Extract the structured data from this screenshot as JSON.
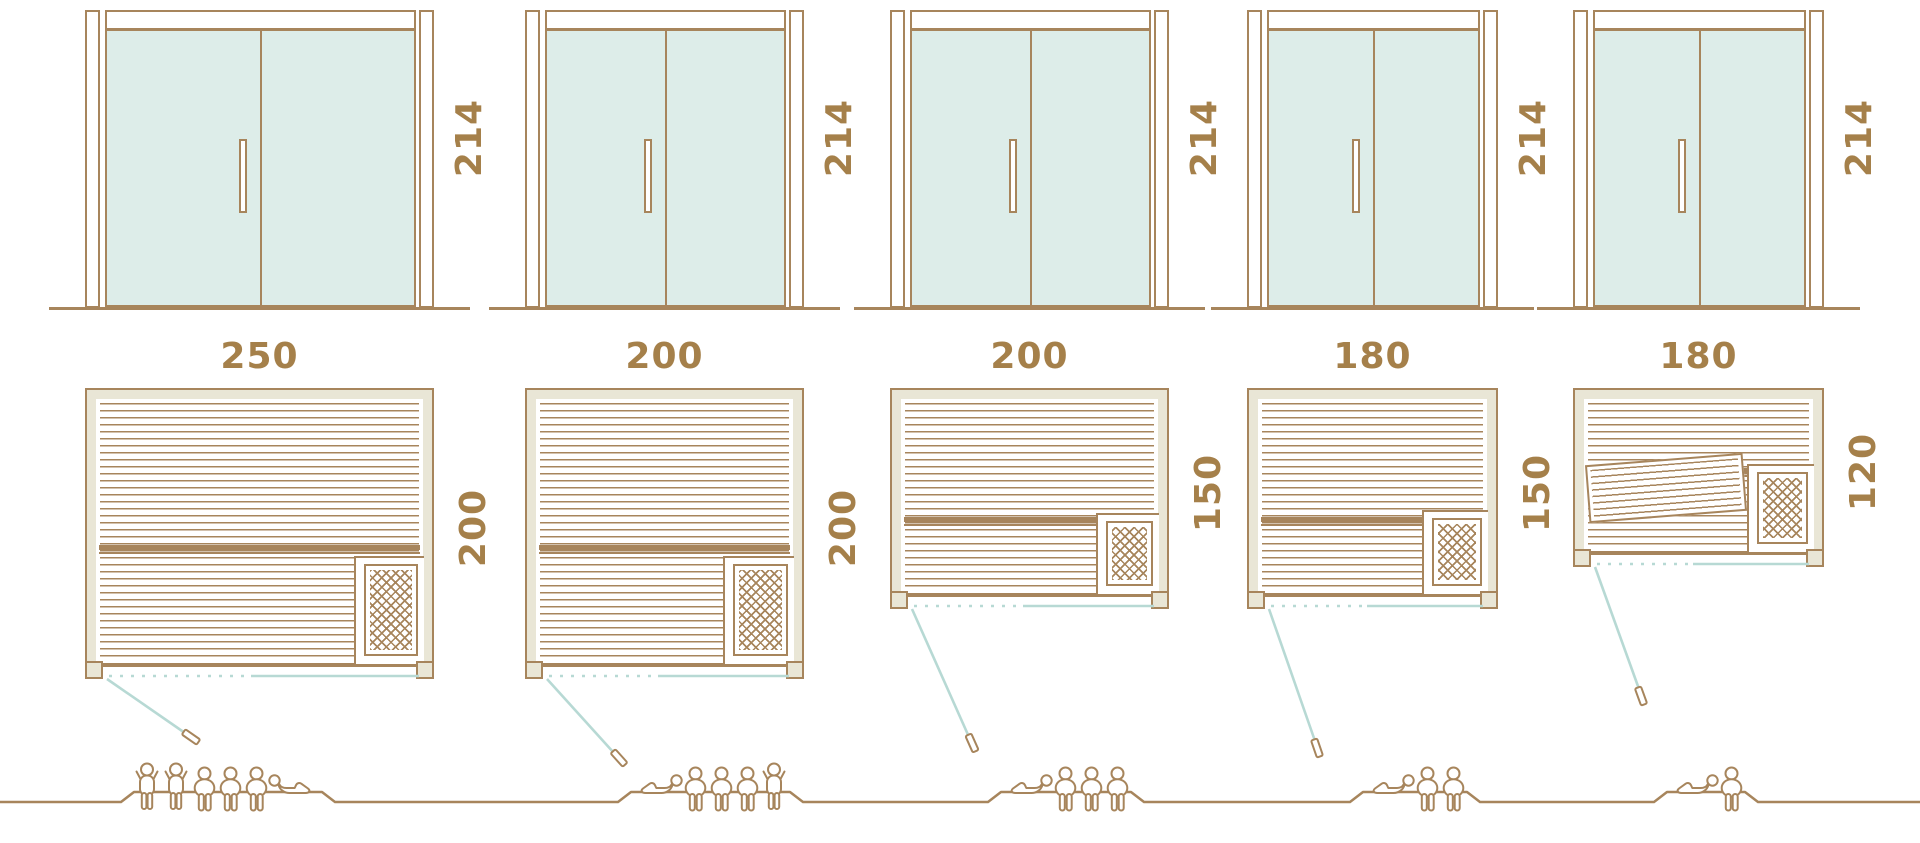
{
  "diagram": {
    "name": "sauna-size-comparison",
    "door_type": "glass-double-door-elevation",
    "colors": {
      "outline_brown": "#a7855c",
      "dimension_text": "#a5804a",
      "glass_teal": "#ddede9",
      "wall_beige": "#e9e6d6",
      "door_swing_teal": "#b7d9d4",
      "background": "#ffffff"
    }
  },
  "units": [
    {
      "name": "sauna-250x200",
      "door_height_cm": "214",
      "width_cm": "250",
      "depth_cm": "200",
      "capacity": 6,
      "occupants": {
        "standing": 2,
        "sitting": 3,
        "lying": 1
      },
      "lying_icon_side": "right-of-group-head-left",
      "heater_position": "bottom-right",
      "diagonal_bench": false
    },
    {
      "name": "sauna-200x200",
      "door_height_cm": "214",
      "width_cm": "200",
      "depth_cm": "200",
      "capacity": 5,
      "occupants": {
        "standing": 1,
        "sitting": 3,
        "lying": 1
      },
      "lying_icon_side": "left-of-group-head-right",
      "heater_position": "bottom-right",
      "diagonal_bench": false
    },
    {
      "name": "sauna-200x150",
      "door_height_cm": "214",
      "width_cm": "200",
      "depth_cm": "150",
      "capacity": 4,
      "occupants": {
        "standing": 0,
        "sitting": 3,
        "lying": 1
      },
      "lying_icon_side": "left-of-group-head-right",
      "heater_position": "bottom-right",
      "diagonal_bench": false
    },
    {
      "name": "sauna-180x150",
      "door_height_cm": "214",
      "width_cm": "180",
      "depth_cm": "150",
      "capacity": 3,
      "occupants": {
        "standing": 0,
        "sitting": 2,
        "lying": 1
      },
      "lying_icon_side": "left-of-group-head-right",
      "heater_position": "bottom-right",
      "diagonal_bench": false
    },
    {
      "name": "sauna-180x120",
      "door_height_cm": "214",
      "width_cm": "180",
      "depth_cm": "120",
      "capacity": 2,
      "occupants": {
        "standing": 0,
        "sitting": 1,
        "lying": 1
      },
      "lying_icon_side": "left-of-group-head-right",
      "heater_position": "bottom-right",
      "diagonal_bench": true
    }
  ],
  "icons": {
    "standing": "person-standing-icon",
    "sitting": "person-sitting-icon",
    "lying": "person-lying-icon",
    "heater": "heater-lattice-icon",
    "handle": "door-handle-icon"
  }
}
